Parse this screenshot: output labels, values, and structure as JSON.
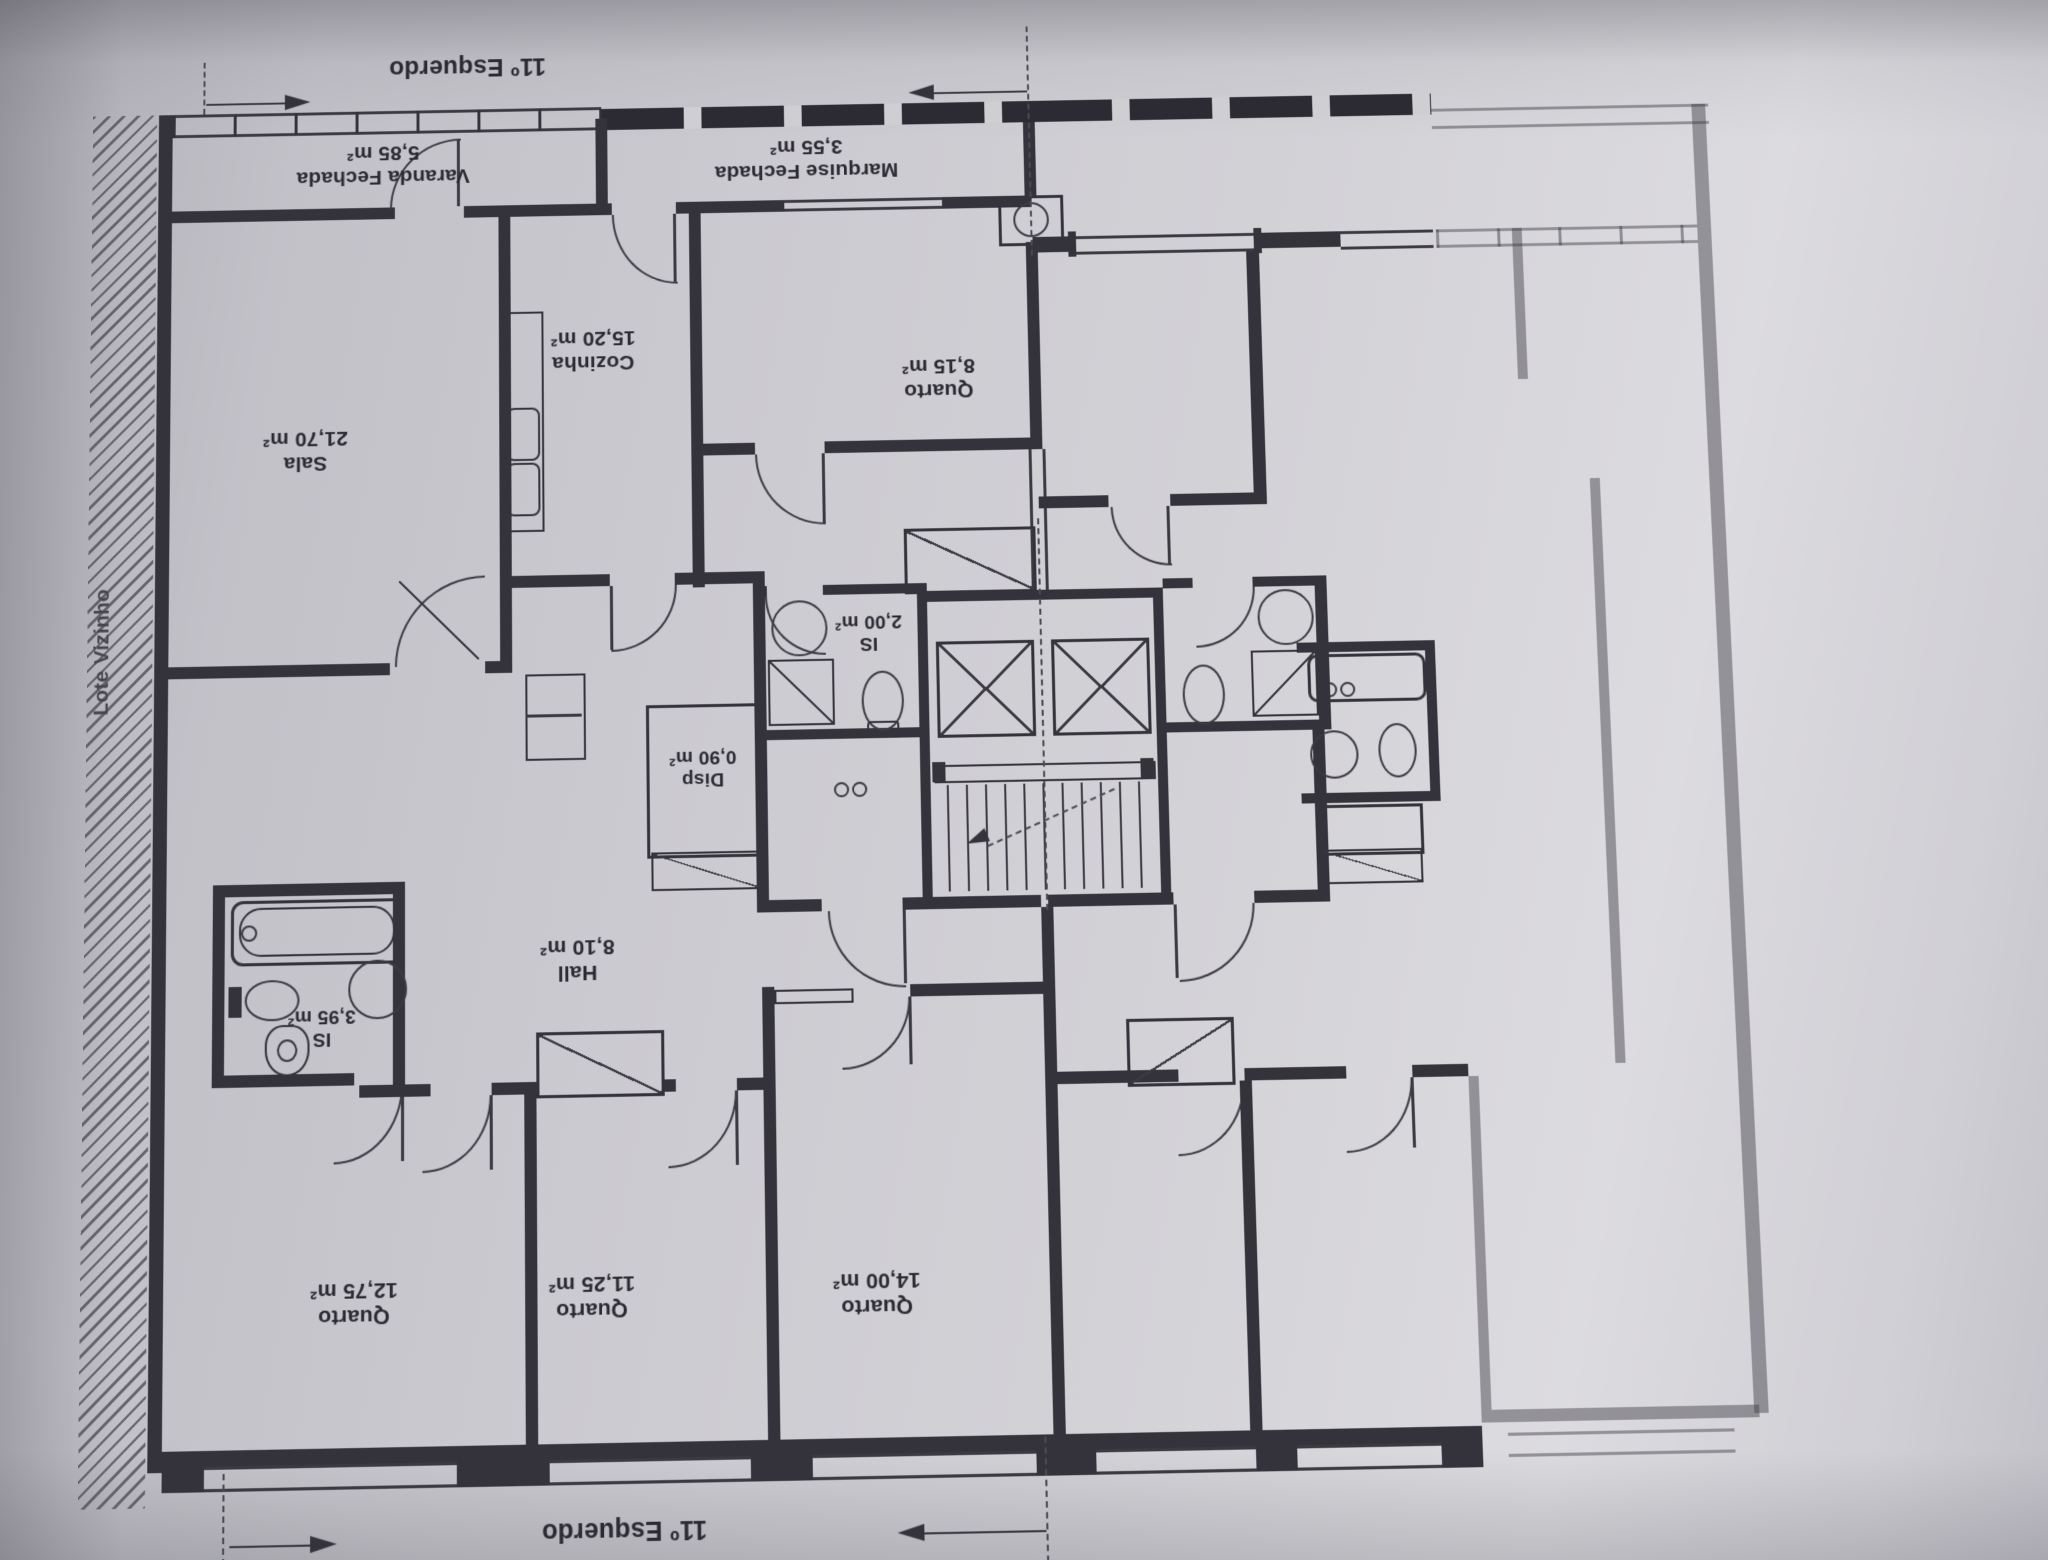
{
  "plan": {
    "unit_top_label": "11º Esquerdo",
    "unit_bottom_label": "11º Esquerdo",
    "site_boundary_label": "Lote Vizinho",
    "rooms": {
      "varanda": {
        "name": "Varanda Fechada",
        "area": "5,85 m²"
      },
      "marquise": {
        "name": "Marquise Fechada",
        "area": "3,55 m²"
      },
      "sala": {
        "name": "Sala",
        "area": "21,70 m²"
      },
      "cozinha": {
        "name": "Cozinha",
        "area": "15,20 m²"
      },
      "quarto_pequeno": {
        "name": "Quarto",
        "area": "8,15 m²"
      },
      "is_servico": {
        "name": "IS",
        "area": "2,00 m²"
      },
      "disp": {
        "name": "Disp",
        "area": "0,90 m²"
      },
      "hall": {
        "name": "Hall",
        "area": "8,10 m²"
      },
      "is_principal": {
        "name": "IS",
        "area": "3,95 m²"
      },
      "quarto_1": {
        "name": "Quarto",
        "area": "12,75 m²"
      },
      "quarto_2": {
        "name": "Quarto",
        "area": "11,25 m²"
      },
      "quarto_3": {
        "name": "Quarto",
        "area": "14,00 m²"
      }
    },
    "colors": {
      "paper": "#cdccd2",
      "ink": "#34333b"
    }
  }
}
